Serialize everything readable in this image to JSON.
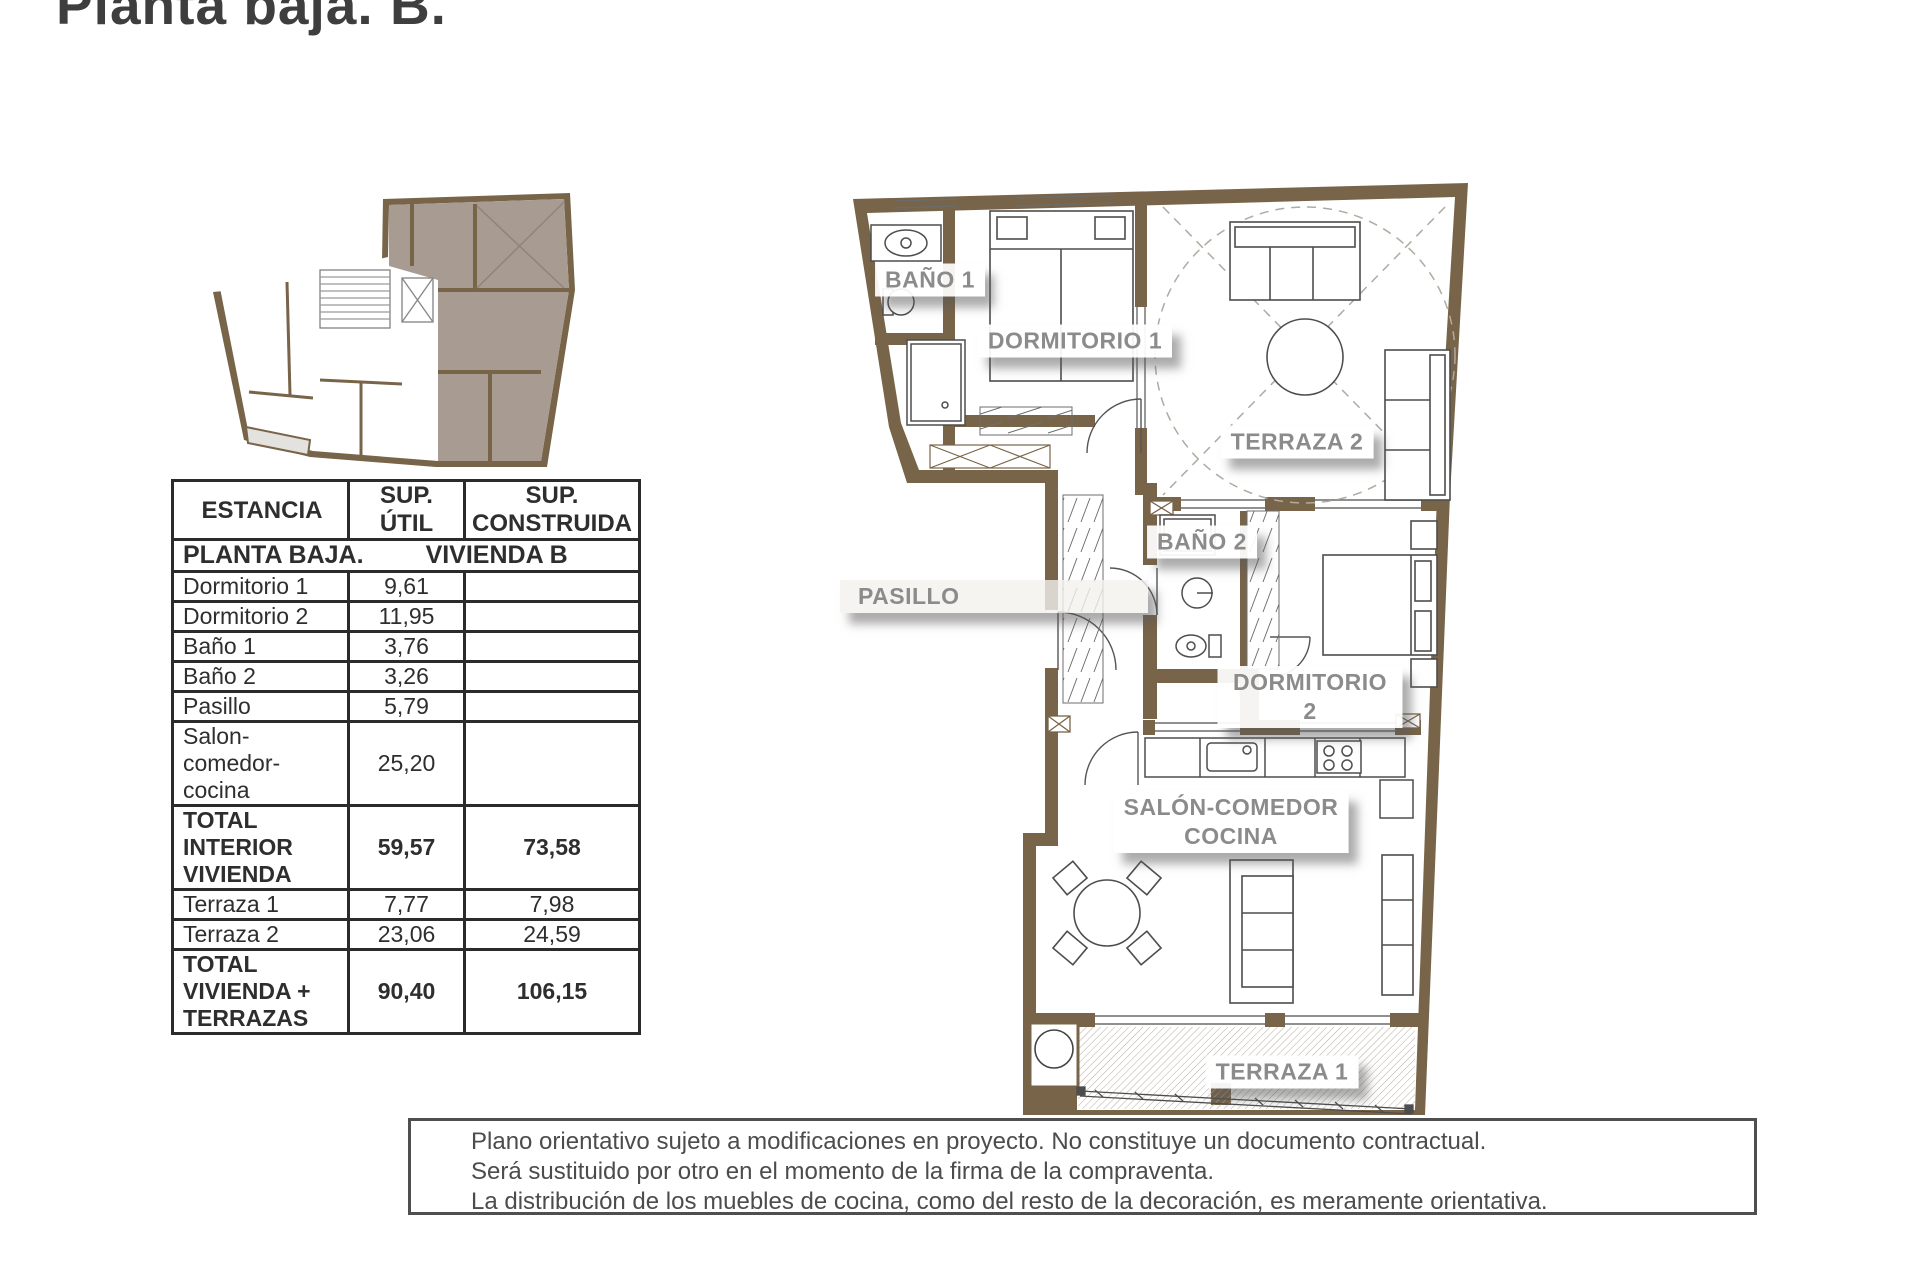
{
  "page": {
    "title": "Planta baja. B."
  },
  "colors": {
    "wall_brown": "#786448",
    "unit_highlight": "#a89c92",
    "terrace_gray": "#e3e2de",
    "label_gray": "#8b8b8b",
    "line_dark": "#4a4a4a"
  },
  "plan": {
    "labels": {
      "banyo1": "BAÑO 1",
      "dormitorio1": "DORMITORIO 1",
      "terraza2": "TERRAZA 2",
      "banyo2": "BAÑO 2",
      "pasillo": "PASILLO",
      "dormitorio2": "DORMITORIO 2",
      "salon": "SALÓN-COMEDOR\nCOCINA",
      "terraza1": "TERRAZA 1"
    }
  },
  "table": {
    "headers": [
      "ESTANCIA",
      "SUP.\nÚTIL",
      "SUP.\nCONSTRUIDA"
    ],
    "section": {
      "left": "PLANTA BAJA.",
      "right": "VIVIENDA B"
    },
    "rows": [
      {
        "name": "Dormitorio 1",
        "util": "9,61",
        "cons": ""
      },
      {
        "name": "Dormitorio 2",
        "util": "11,95",
        "cons": ""
      },
      {
        "name": "Baño 1",
        "util": "3,76",
        "cons": ""
      },
      {
        "name": "Baño 2",
        "util": "3,26",
        "cons": ""
      },
      {
        "name": "Pasillo",
        "util": "5,79",
        "cons": ""
      },
      {
        "name": "Salon-\ncomedor-\ncocina",
        "util": "25,20",
        "cons": ""
      },
      {
        "name": "TOTAL\nINTERIOR\nVIVIENDA",
        "util": "59,57",
        "cons": "73,58"
      },
      {
        "name": "Terraza 1",
        "util": "7,77",
        "cons": "7,98"
      },
      {
        "name": "Terraza 2",
        "util": "23,06",
        "cons": "24,59"
      },
      {
        "name": "TOTAL\nVIVIENDA +\nTERRAZAS",
        "util": "90,40",
        "cons": "106,15"
      }
    ]
  },
  "disclaimer": {
    "lines": [
      "Plano orientativo sujeto a modificaciones en proyecto. No constituye un documento contractual.",
      "Será sustituido por otro en el momento de la firma de la compraventa.",
      "La distribución de los muebles de cocina, como del resto de la decoración, es meramente orientativa."
    ]
  }
}
